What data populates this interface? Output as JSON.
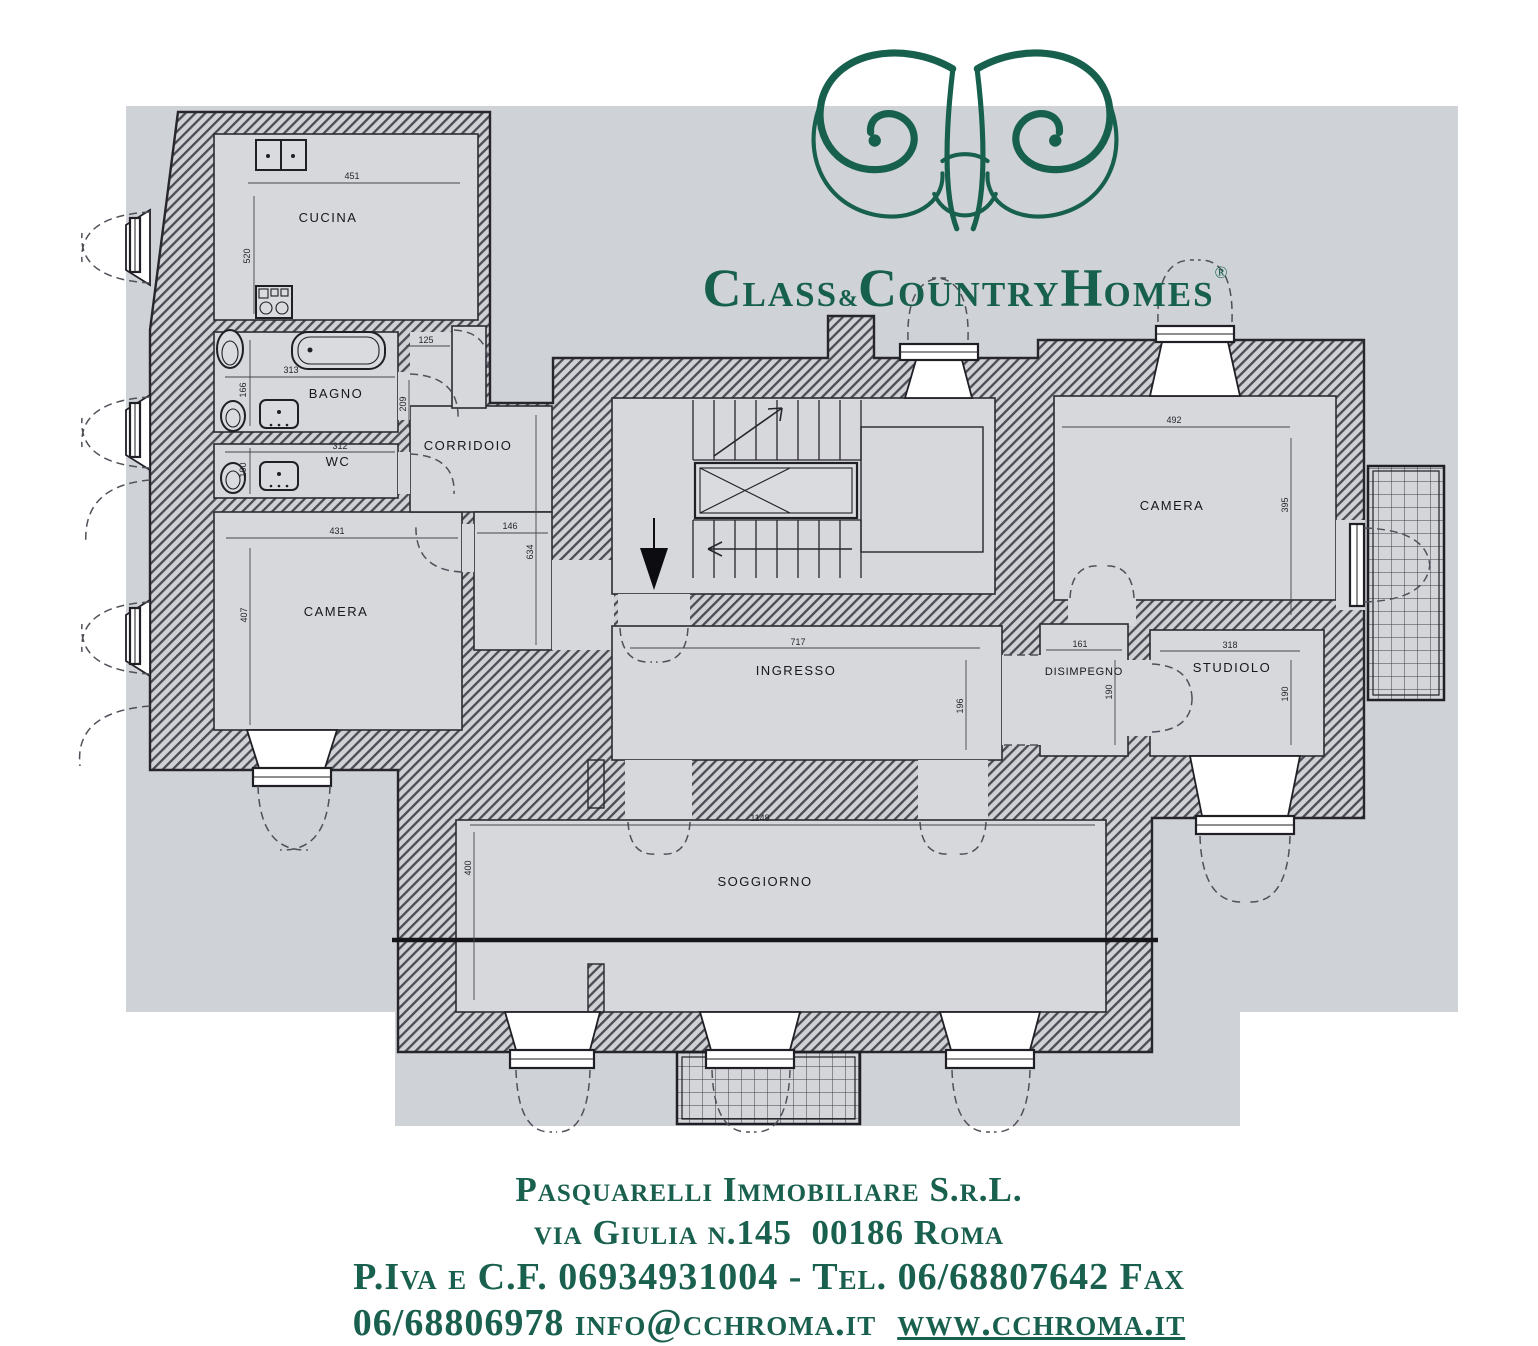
{
  "brand": {
    "c1": "C",
    "s1": "LASS",
    "amp": "&",
    "c2": "C",
    "s2": "OUNTRY",
    "c3": "H",
    "s3": "OMES",
    "reg": "®"
  },
  "footer": {
    "line1": "Pasquarelli Immobiliare S.r.L.",
    "line2": "via Giulia n.145  00186 Roma",
    "line3": "P.Iva e C.F. 06934931004 - Tel. 06/68807642 Fax",
    "line4_prefix": "06/68806978 info@cchroma.it  ",
    "line4_link": "www.cchroma.it"
  },
  "plan": {
    "rooms": {
      "cucina": "CUCINA",
      "bagno": "BAGNO",
      "wc": "WC",
      "corridoio": "CORRIDOIO",
      "camera_sx": "CAMERA",
      "ingresso": "INGRESSO",
      "disimpegno": "DISIMPEGNO",
      "studiolo": "STUDIOLO",
      "camera_dx": "CAMERA",
      "soggiorno": "SOGGIORNO"
    },
    "dims": {
      "cucina_w": "451",
      "cucina_h": "520",
      "bagno_w": "313",
      "bagno_h": "166",
      "wc_w": "312",
      "wc_h": "100",
      "corridoio_entry": "125",
      "corridoio_mid": "209",
      "corridoio_w": "146",
      "corridoio_h": "634",
      "camera_sx_w": "431",
      "camera_sx_h": "407",
      "ingresso_w": "717",
      "ingresso_h": "196",
      "disimpegno_w": "161",
      "disimpegno_h": "190",
      "studiolo_w": "318",
      "studiolo_h": "190",
      "camera_dx_w": "492",
      "camera_dx_h": "395",
      "soggiorno_w": "1148",
      "soggiorno_h": "400"
    }
  },
  "colors": {
    "brand_green": "#17604d",
    "plan_paper": "#cfd2d6",
    "floor": "#d6d8dc",
    "ink": "#26262c"
  }
}
